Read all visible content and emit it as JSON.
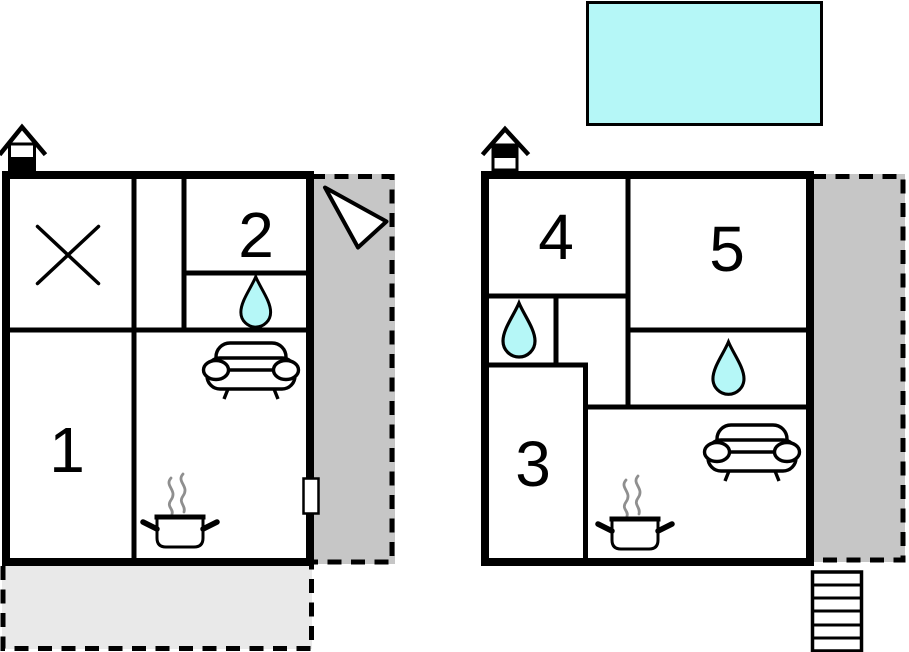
{
  "document": {
    "type": "floor-plan",
    "background": "#ffffff"
  },
  "colors": {
    "wall": "#000000",
    "water": "#b5f7f7",
    "terrace_dark": "#c6c6c6",
    "terrace_light": "#e9e9e9",
    "steam": "#8f8f8f",
    "icon_fill": "#ffffff"
  },
  "plans": {
    "left": {
      "name": "floor-plan-unit-1",
      "rooms": {
        "room1": "1",
        "room2": "2"
      },
      "icons": [
        "chimney-house-icon",
        "window-x-icon",
        "shower-drop-icon",
        "sofa-icon",
        "stove-pot-icon",
        "entrance-door",
        "north-arrow-icon"
      ],
      "areas": [
        "side-terrace",
        "bottom-patio"
      ]
    },
    "right": {
      "name": "floor-plan-unit-2",
      "rooms": {
        "room3": "3",
        "room4": "4",
        "room5": "5"
      },
      "icons": [
        "chimney-house-icon",
        "shower-drop-icon",
        "shower-drop-icon",
        "sofa-icon",
        "stove-pot-icon",
        "stairs-icon"
      ],
      "areas": [
        "swimming-pool",
        "side-terrace"
      ]
    }
  }
}
